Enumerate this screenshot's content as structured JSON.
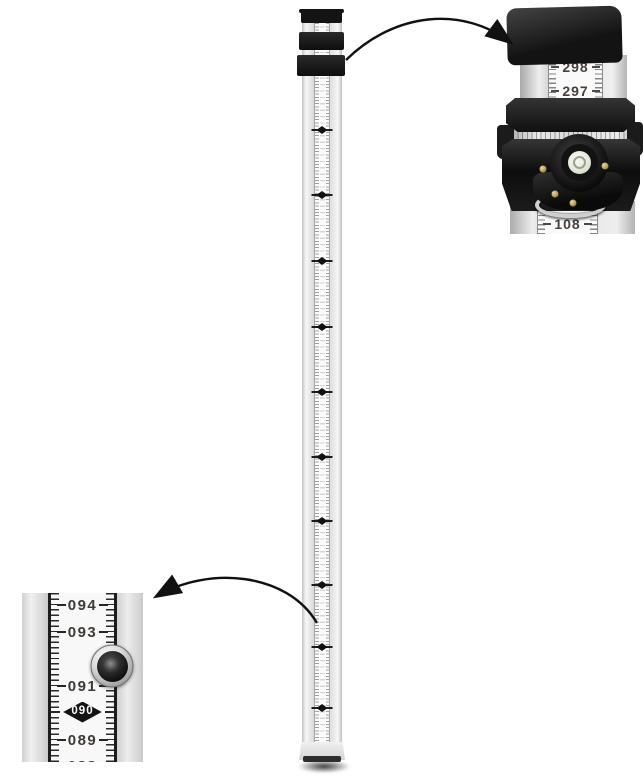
{
  "image": {
    "type": "product-photo",
    "subject": "telescoping aluminum leveling rod (grade staff) with two zoom detail callouts",
    "background": "#ffffff"
  },
  "rod": {
    "diamond_ys": [
      130,
      195,
      261,
      327,
      392,
      457,
      521,
      585,
      647,
      708
    ]
  },
  "top_callout": {
    "upper_numbers": [
      "298",
      "297"
    ],
    "lower_number": "108"
  },
  "left_callout": {
    "rows": [
      {
        "label": "094",
        "type": "number",
        "y": 12
      },
      {
        "label": "093",
        "type": "number",
        "y": 39
      },
      {
        "label": "091",
        "type": "number",
        "y": 93
      },
      {
        "label": "090",
        "type": "diamond",
        "y": 119
      },
      {
        "label": "089",
        "type": "number",
        "y": 147
      },
      {
        "label": "088",
        "type": "number",
        "y": 173
      }
    ]
  },
  "colors": {
    "background": "#ffffff",
    "black_parts": "#1a1a1a",
    "aluminum": "#e2e2e2",
    "scale_strip": "#f8f8f8",
    "scale_text": "#3e3a35",
    "diamond_marker": "#141414",
    "diamond_text": "#ffffff",
    "vial_glass": "#e9efdf",
    "brass_screw": "#b49a52",
    "arrow": "#111111"
  }
}
